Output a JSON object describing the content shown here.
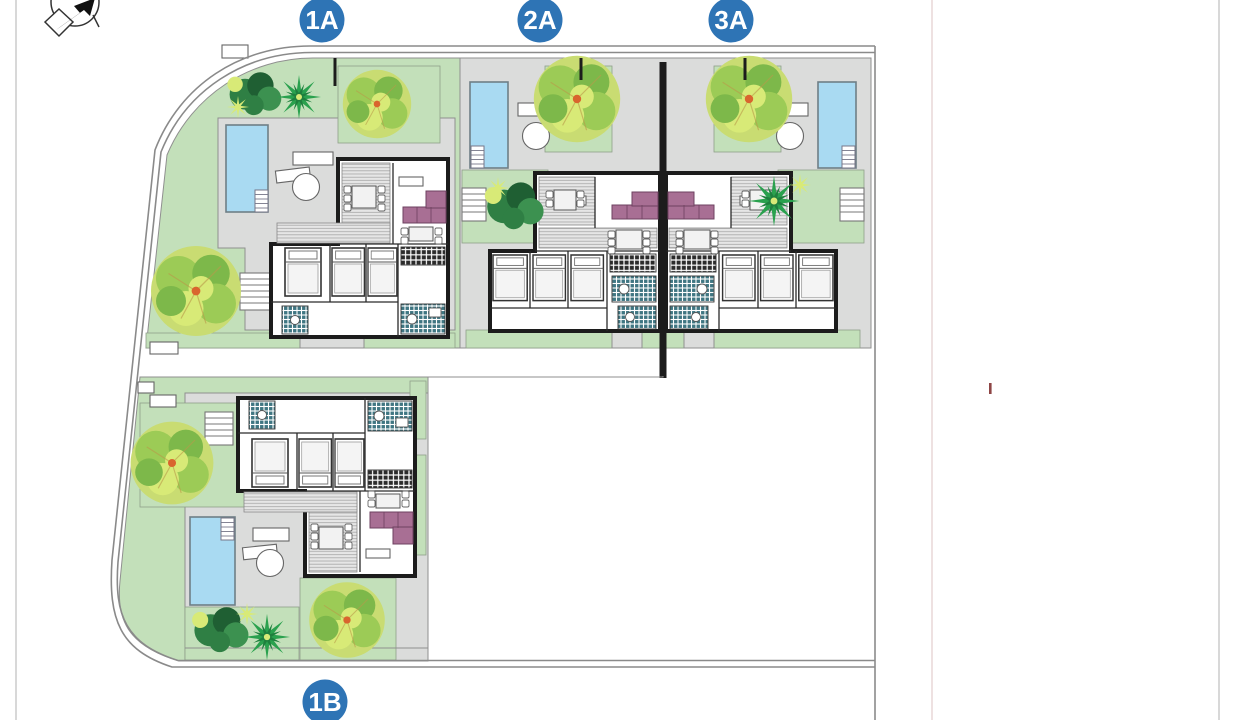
{
  "badges": {
    "items": [
      {
        "label": "1A"
      },
      {
        "label": "2A"
      },
      {
        "label": "3A"
      },
      {
        "label": "1B"
      }
    ]
  },
  "icons": {
    "compass": "north-arrow-compass",
    "red_marker": "revision-tick"
  },
  "colors": {
    "badge_blue": "#2e74b5",
    "badge_text": "#ffffff",
    "garden_green": "#c3e0ba",
    "paving_gray": "#dbdcdb",
    "paving_stroke": "#8f8f8f",
    "pool_blue": "#a9daf2",
    "wall_black": "#1c1c1c",
    "sofa_mauve": "#a86f94",
    "bath_teal": "#3f7682",
    "boundary_gray": "#8a8a8a",
    "page_border": "#cbcbcb",
    "faint_red": "#dcc3c3",
    "marker_red": "#8e4545",
    "tree_yellow": "#c9dc72",
    "tree_mid": "#9ccb56",
    "tree_olive": "#7db84a",
    "tree_dark": "#2f7f44",
    "tree_darker": "#1f5f33",
    "tree_lime": "#d8ea77",
    "tree_center": "#d9652e"
  }
}
